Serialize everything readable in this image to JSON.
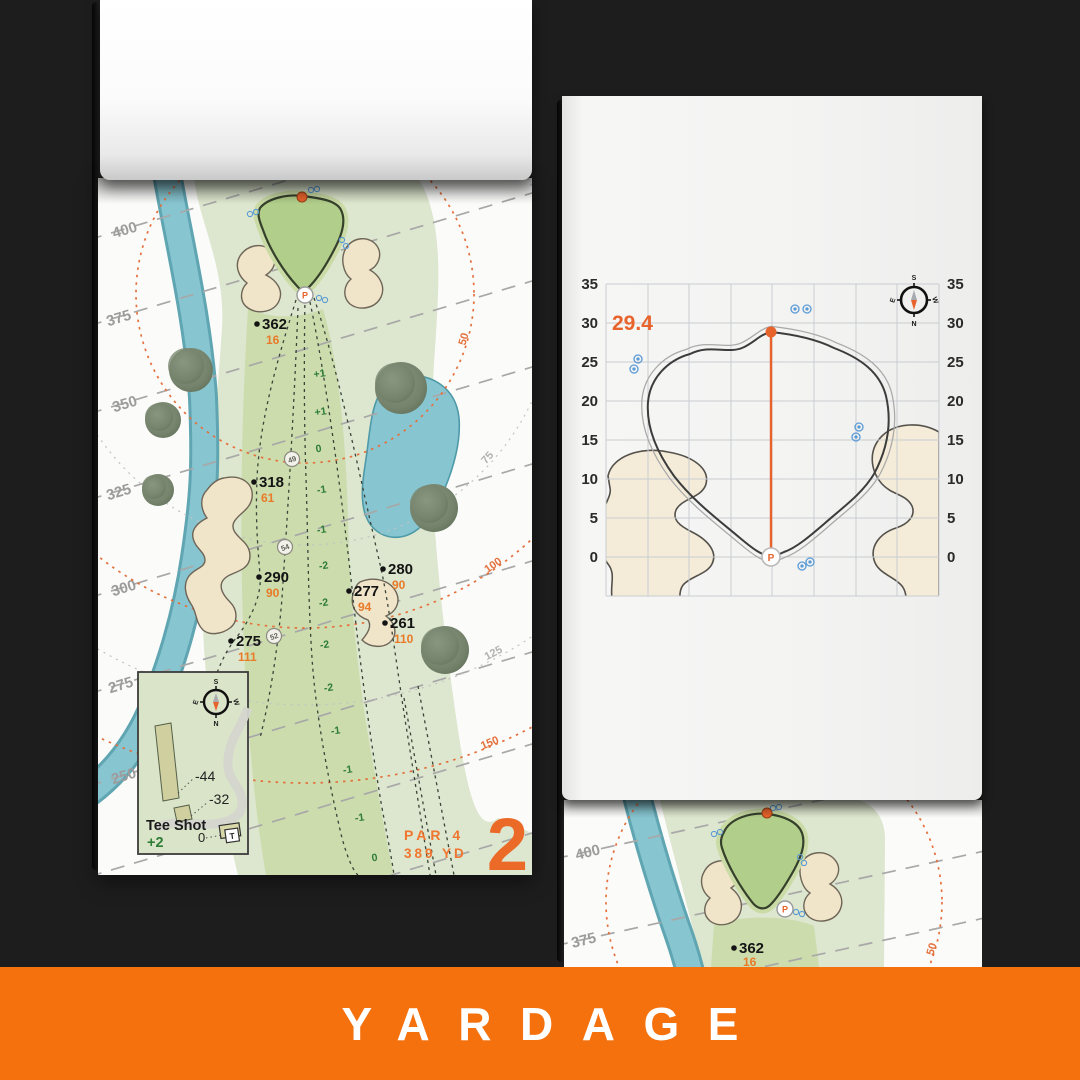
{
  "banner": {
    "label": "YARDAGE"
  },
  "left_page": {
    "hole_number": "2",
    "par_label": "PAR 4",
    "distance_label": "389 YD",
    "rings": [
      "400",
      "375",
      "350",
      "325",
      "300",
      "275",
      "250"
    ],
    "arcs": [
      "50",
      "75",
      "100",
      "125",
      "150"
    ],
    "points": [
      {
        "dist": "362",
        "front": "16"
      },
      {
        "dist": "318",
        "front": "61"
      },
      {
        "dist": "290",
        "front": "90"
      },
      {
        "dist": "275",
        "front": "111"
      },
      {
        "dist": "280",
        "front": "90"
      },
      {
        "dist": "277",
        "front": "94"
      },
      {
        "dist": "261",
        "front": "110"
      }
    ],
    "slopes": [
      "+1",
      "+1",
      "0",
      "-1",
      "-1",
      "-2",
      "-2",
      "-2",
      "-2",
      "-1",
      "-1",
      "-1",
      "0"
    ],
    "markers": [
      "49",
      "54",
      "52"
    ],
    "tee": {
      "title": "Tee Shot",
      "score": "+2",
      "zero": "0",
      "tee_letter": "T",
      "long": "-44",
      "short": "-32"
    },
    "compass": {
      "n": "N",
      "s": "S",
      "e": "E",
      "w": "W"
    },
    "pin": "P"
  },
  "right_page": {
    "depth": "29.4",
    "ticks": [
      "35",
      "30",
      "25",
      "20",
      "15",
      "10",
      "5",
      "0"
    ],
    "pin": "P",
    "compass": {
      "n": "N",
      "s": "S",
      "e": "E",
      "w": "W"
    }
  },
  "under_page": {
    "rings": [
      "400",
      "375"
    ],
    "arc": "50",
    "point": {
      "dist": "362",
      "front": "16"
    }
  }
}
